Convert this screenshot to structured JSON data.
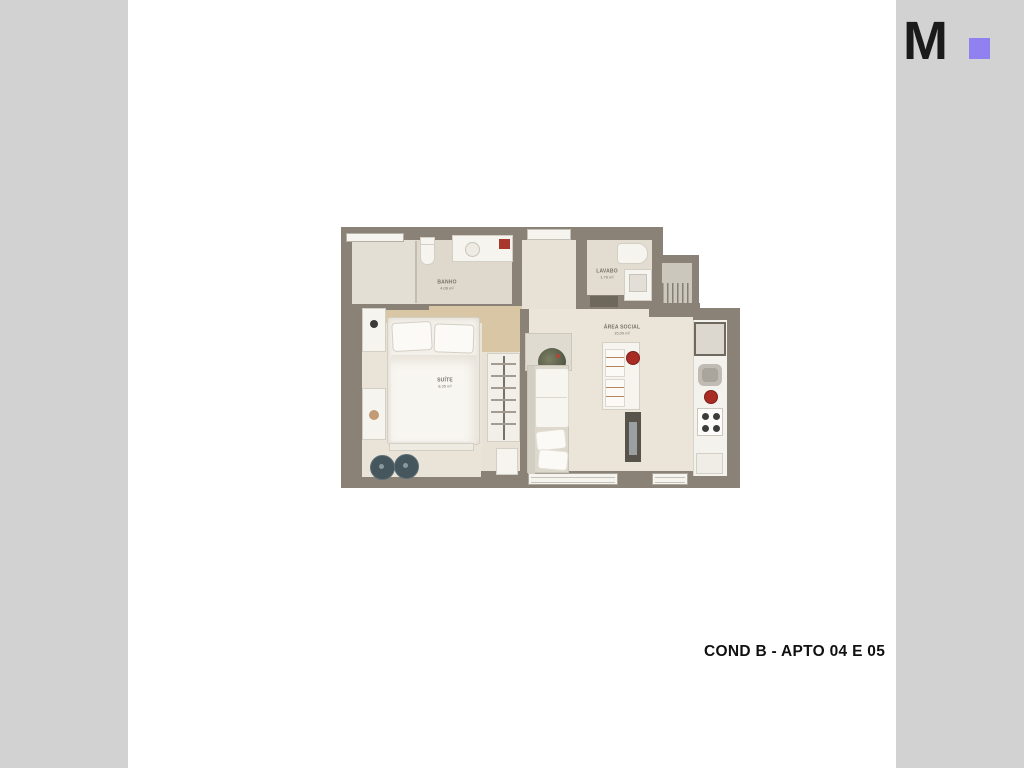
{
  "page": {
    "caption": "COND B - APTO 04 E 05",
    "background_color": "#ffffff",
    "side_panel_color": "#d2d2d2"
  },
  "logo": {
    "letter": "M",
    "letter_color": "#1a1a1a",
    "dot_color": "#8f82f0"
  },
  "floor_plan": {
    "type": "apartment-floor-plan-render",
    "colors": {
      "wall": "#8b8277",
      "floor": "#e9e3d8",
      "floor_bath": "#ded8cd",
      "wood": "#d9c6a4",
      "furniture": "#f6f4ef",
      "accent_red": "#a82c24",
      "pouf": "#45565d"
    },
    "rooms": [
      {
        "id": "banho",
        "name": "BANHO",
        "area": "4,06 m²"
      },
      {
        "id": "lavabo",
        "name": "LAVABO",
        "area": "1,76 m²"
      },
      {
        "id": "area_social",
        "name": "ÁREA SOCIAL",
        "area": "15,00 m²"
      },
      {
        "id": "suite",
        "name": "SUÍTE",
        "area": "8,35 m²"
      }
    ],
    "features": [
      "bed",
      "nightstands",
      "poufs",
      "wardrobe",
      "sofa",
      "plant",
      "dining-counter",
      "stools",
      "tv-panel",
      "fridge",
      "sink",
      "stove",
      "toilet",
      "shower",
      "windows"
    ]
  }
}
